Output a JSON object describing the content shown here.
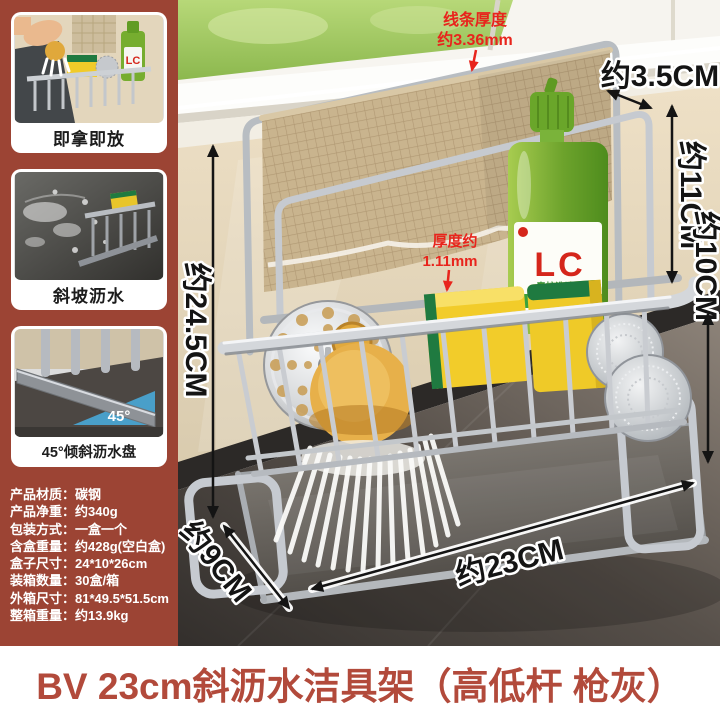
{
  "sidebar": {
    "features": [
      {
        "caption": "即拿即放"
      },
      {
        "caption": "斜坡沥水"
      },
      {
        "caption": "45°倾斜沥水盘",
        "angle_label": "45°"
      }
    ],
    "specs": [
      {
        "label": "产品材质：",
        "value": "碳钢"
      },
      {
        "label": "产品净重：",
        "value": "约340g"
      },
      {
        "label": "包装方式：",
        "value": "一盒一个"
      },
      {
        "label": "含盒重量：",
        "value": "约428g(空白盒)"
      },
      {
        "label": "盒子尺寸：",
        "value": "24*10*26cm"
      },
      {
        "label": "装箱数量：",
        "value": "30盒/箱"
      },
      {
        "label": "外箱尺寸：",
        "value": "81*49.5*51.5cm"
      },
      {
        "label": "整箱重量：",
        "value": "约13.9kg"
      }
    ]
  },
  "annotations": {
    "wire_thickness_1": "线条厚度",
    "wire_thickness_2": "约3.36mm",
    "hook_gap": "约3.5CM",
    "upper_height": "约11CM",
    "lower_height": "约10CM",
    "total_height": "约24.5CM",
    "plate_thickness_1": "厚度约",
    "plate_thickness_2": "1.11mm",
    "depth": "约9CM",
    "width": "约23CM"
  },
  "product": {
    "soap_brand": "LC",
    "soap_name": "青柠洗洁精",
    "soap_tagline": "柠檬原液去油"
  },
  "banner": {
    "title": "BV 23cm斜沥水洁具架（高低杆 枪灰）"
  },
  "colors": {
    "panel": "#9c4434",
    "banner_text": "#b24a3b",
    "annotation_red": "#e8241c",
    "dim_black": "#141414"
  }
}
